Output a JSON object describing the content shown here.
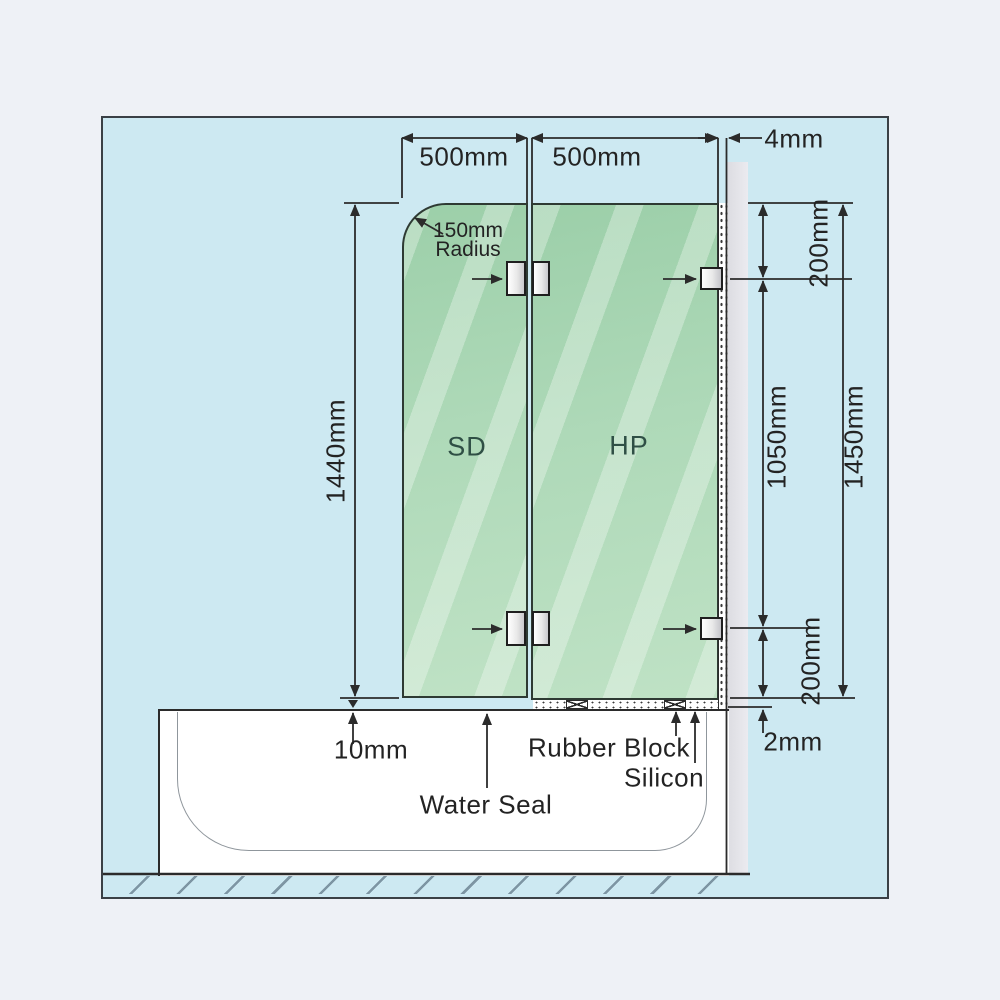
{
  "diagram": {
    "subject": "frameless-bath-shower-screen-installation",
    "dimensions": {
      "sd_width": "500mm",
      "hp_width": "500mm",
      "wall_gap": "4mm",
      "radius_value": "150mm",
      "radius_word": "Radius",
      "door_height": "1440mm",
      "top_bracket_offset": "200mm",
      "bracket_span": "1050mm",
      "panel_height": "1450mm",
      "bottom_bracket_offset": "200mm",
      "floor_gap": "10mm",
      "base_gap": "2mm"
    },
    "labels": {
      "sd": "SD",
      "hp": "HP",
      "water_seal": "Water Seal",
      "rubber_block": "Rubber Block",
      "silicon": "Silicon"
    },
    "colors": {
      "page_background": "#eef1f6",
      "diagram_background": "#cde9f2",
      "glass_dark": "#9ccfa9",
      "glass_light": "#bfe2c5",
      "wall_strip": "#e2e2e7",
      "line": "#2b2b2b"
    }
  }
}
